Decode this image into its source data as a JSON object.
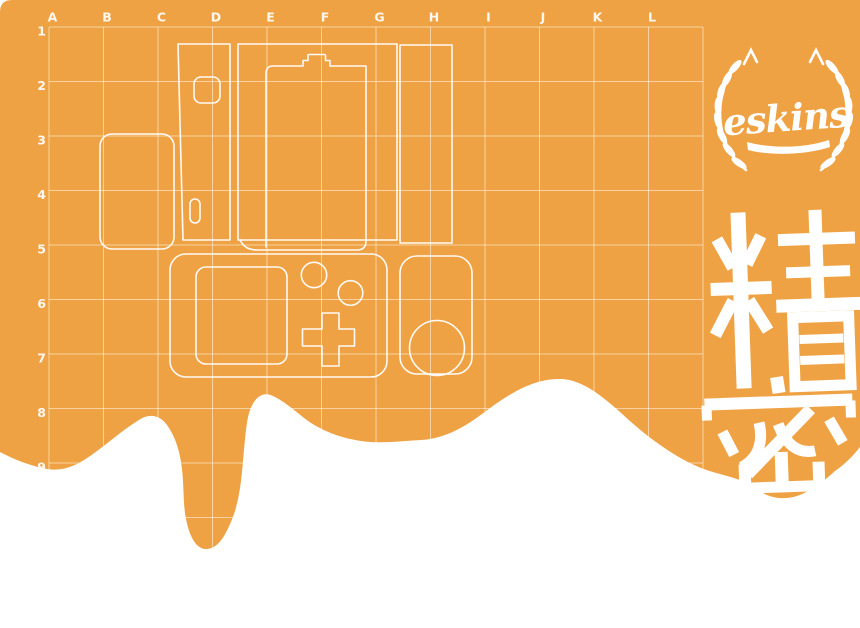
{
  "colors": {
    "orange": "#EFA243",
    "white": "#FFFFFF"
  },
  "grid": {
    "columns": [
      "A",
      "B",
      "C",
      "D",
      "E",
      "F",
      "G",
      "H",
      "I",
      "J",
      "K",
      "L"
    ],
    "rows": [
      "1",
      "2",
      "3",
      "4",
      "5",
      "6",
      "7",
      "8",
      "9"
    ]
  },
  "logo": {
    "text": "eskins"
  },
  "stamp": {
    "text": "精密"
  }
}
